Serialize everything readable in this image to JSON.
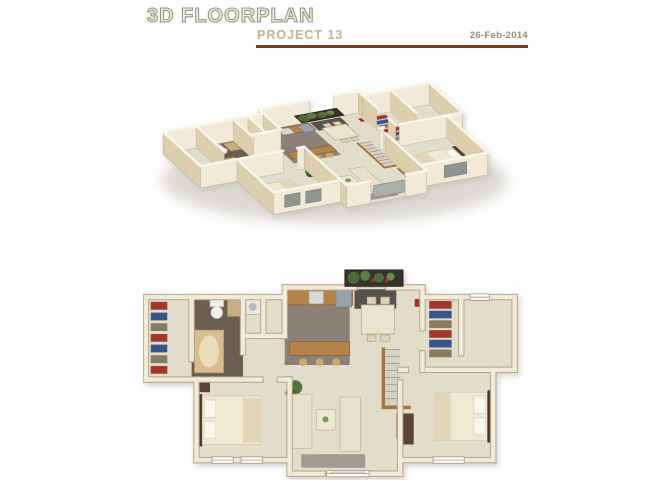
{
  "header": {
    "title": "3D FLOORPLAN",
    "subtitle": "PROJECT 13",
    "date": "26-Feb-2014"
  },
  "palette": {
    "title_olive": "#8f9481",
    "subtitle_tan": "#c7b291",
    "date_brown": "#9b8b77",
    "rule_brick": "#7e3c20",
    "floor": "#e2dccb",
    "wall_fill": "#f1ead8",
    "wall_outline": "#b3a68b",
    "wall_side": "#dbcfae",
    "wall_cap": "#faf6ea",
    "window_dark": "#8f948f",
    "wood": "#b3834a",
    "shadow": "#b9b3a5"
  },
  "views": {
    "isometric": {
      "type": "iso",
      "a": 0.7,
      "b": -0.13,
      "c": 0.44,
      "d": 0.4,
      "tx": 10,
      "ty": 86,
      "wall_h": 22
    },
    "plan": {
      "type": "flat",
      "s": 0.97,
      "tx": 3,
      "ty": 2
    }
  },
  "floorplan": {
    "size": [
      380,
      220
    ],
    "outline": [
      [
        0,
        30
      ],
      [
        143,
        30
      ],
      [
        143,
        20
      ],
      [
        215,
        20
      ],
      [
        250,
        20
      ],
      [
        285,
        20
      ],
      [
        285,
        30
      ],
      [
        380,
        30
      ],
      [
        380,
        105
      ],
      [
        358,
        105
      ],
      [
        358,
        198
      ],
      [
        262,
        198
      ],
      [
        262,
        212
      ],
      [
        148,
        212
      ],
      [
        148,
        198
      ],
      [
        52,
        198
      ],
      [
        52,
        115
      ],
      [
        0,
        115
      ]
    ],
    "walls": [
      [
        0,
        30,
        143,
        30
      ],
      [
        143,
        30,
        143,
        20
      ],
      [
        143,
        20,
        215,
        20
      ],
      [
        250,
        20,
        285,
        20
      ],
      [
        285,
        20,
        285,
        30
      ],
      [
        285,
        30,
        380,
        30
      ],
      [
        380,
        30,
        380,
        105
      ],
      [
        380,
        105,
        358,
        105
      ],
      [
        358,
        105,
        358,
        198
      ],
      [
        358,
        198,
        262,
        198
      ],
      [
        262,
        198,
        262,
        212
      ],
      [
        262,
        212,
        232,
        212
      ],
      [
        182,
        212,
        148,
        212
      ],
      [
        148,
        212,
        148,
        198
      ],
      [
        148,
        198,
        52,
        198
      ],
      [
        52,
        198,
        52,
        115
      ],
      [
        52,
        115,
        0,
        115
      ],
      [
        0,
        115,
        0,
        30
      ],
      [
        47,
        30,
        47,
        94
      ],
      [
        100,
        30,
        100,
        87
      ],
      [
        52,
        115,
        118,
        115
      ],
      [
        138,
        115,
        148,
        115
      ],
      [
        148,
        115,
        148,
        198
      ],
      [
        121,
        30,
        121,
        70
      ],
      [
        104,
        70,
        143,
        70
      ],
      [
        143,
        30,
        143,
        70
      ],
      [
        285,
        30,
        285,
        62
      ],
      [
        285,
        88,
        285,
        105
      ],
      [
        325,
        30,
        325,
        88
      ],
      [
        262,
        105,
        268,
        105
      ],
      [
        290,
        105,
        358,
        105
      ],
      [
        262,
        118,
        262,
        198
      ]
    ],
    "patches": [
      {
        "x": 47,
        "y": 30,
        "w": 53,
        "h": 85,
        "f": "#6a5e50"
      },
      {
        "x": 143,
        "y": 20,
        "w": 67,
        "h": 80,
        "f": "#8b8177"
      },
      {
        "x": 215,
        "y": 22,
        "w": 43,
        "h": 20,
        "f": "#57524b"
      }
    ],
    "furniture": [
      {
        "t": "rect",
        "x": 145,
        "y": 22,
        "w": 68,
        "h": 16,
        "f": "#b3834a",
        "s": "#8a6236"
      },
      {
        "t": "rect",
        "x": 196,
        "y": 23,
        "w": 16,
        "h": 17,
        "f": "#9aa1a8",
        "s": "#7d848b"
      },
      {
        "t": "rect",
        "x": 168,
        "y": 24,
        "w": 15,
        "h": 13,
        "f": "#d9d9d4",
        "s": "#a8a8a2"
      },
      {
        "t": "rect",
        "x": 148,
        "y": 76,
        "w": 62,
        "h": 14,
        "f": "#b3834a",
        "s": "#8a6236"
      },
      {
        "t": "circle",
        "cx": 162,
        "cy": 97,
        "r": 4,
        "f": "#c9a96e"
      },
      {
        "t": "circle",
        "cx": 179,
        "cy": 97,
        "r": 4,
        "f": "#c9a96e"
      },
      {
        "t": "circle",
        "cx": 196,
        "cy": 97,
        "r": 4,
        "f": "#c9a96e"
      },
      {
        "t": "rect",
        "x": 222,
        "y": 38,
        "w": 34,
        "h": 30,
        "f": "#eae3cf",
        "s": "#b8a97f"
      },
      {
        "t": "rect",
        "x": 228,
        "y": 30,
        "w": 9,
        "h": 7,
        "f": "#ddd3b8",
        "s": "#b8a97f"
      },
      {
        "t": "rect",
        "x": 242,
        "y": 30,
        "w": 9,
        "h": 7,
        "f": "#ddd3b8",
        "s": "#b8a97f"
      },
      {
        "t": "rect",
        "x": 228,
        "y": 69,
        "w": 9,
        "h": 7,
        "f": "#ddd3b8",
        "s": "#b8a97f"
      },
      {
        "t": "rect",
        "x": 242,
        "y": 69,
        "w": 9,
        "h": 7,
        "f": "#ddd3b8",
        "s": "#b8a97f"
      },
      {
        "t": "rect",
        "x": 103,
        "y": 32,
        "w": 15,
        "h": 16,
        "f": "#e9e9e4",
        "s": "#a9aaa6"
      },
      {
        "t": "circle",
        "cx": 110,
        "cy": 40,
        "r": 4,
        "f": "#b9bdc1"
      },
      {
        "t": "stripes",
        "x": 5,
        "y": 35,
        "w": 17,
        "n": 7,
        "sh": 8,
        "gap": 3,
        "cols": [
          "#a23730",
          "#36558c",
          "#8a7a60"
        ]
      },
      {
        "t": "stripes",
        "x": 292,
        "y": 34,
        "w": 23,
        "n": 6,
        "sh": 8,
        "gap": 2,
        "cols": [
          "#a23730",
          "#36558c",
          "#8a7a60"
        ]
      },
      {
        "t": "rect",
        "x": 50,
        "y": 64,
        "w": 30,
        "h": 44,
        "f": "#d9bd90",
        "s": "#b49a6e",
        "rx": 9
      },
      {
        "t": "ellipse",
        "cx": 65,
        "cy": 86,
        "rx": 10,
        "ry": 16,
        "f": "#e9dcba"
      },
      {
        "t": "rect",
        "x": 66,
        "y": 32,
        "w": 14,
        "h": 8,
        "f": "#efeee8",
        "s": "#b5b5ae"
      },
      {
        "t": "circle",
        "cx": 73,
        "cy": 46,
        "r": 6,
        "f": "#f2f1ea"
      },
      {
        "t": "rect",
        "x": 84,
        "y": 32,
        "w": 15,
        "h": 18,
        "f": "#c7ad7f",
        "s": "#a08a5f"
      },
      {
        "t": "rect",
        "x": 53,
        "y": 130,
        "w": 5,
        "h": 54,
        "f": "#4f3a29"
      },
      {
        "t": "rect",
        "x": 58,
        "y": 132,
        "w": 60,
        "h": 50,
        "f": "#efe8d3",
        "s": "#cfc3a4"
      },
      {
        "t": "rect",
        "x": 60,
        "y": 136,
        "w": 12,
        "h": 18,
        "f": "#f9f6ec",
        "s": "#d8d0b8"
      },
      {
        "t": "rect",
        "x": 60,
        "y": 158,
        "w": 12,
        "h": 18,
        "f": "#f9f6ec",
        "s": "#d8d0b8"
      },
      {
        "t": "rect",
        "x": 100,
        "y": 134,
        "w": 18,
        "h": 46,
        "f": "#e0d5b6"
      },
      {
        "t": "rect",
        "x": 54,
        "y": 118,
        "w": 12,
        "h": 10,
        "f": "#5a4433"
      },
      {
        "t": "rect",
        "x": 298,
        "y": 128,
        "w": 54,
        "h": 50,
        "f": "#efe8d3",
        "s": "#cfc3a4"
      },
      {
        "t": "rect",
        "x": 352,
        "y": 126,
        "w": 5,
        "h": 54,
        "f": "#4f3a29"
      },
      {
        "t": "rect",
        "x": 338,
        "y": 132,
        "w": 12,
        "h": 18,
        "f": "#f9f6ec",
        "s": "#d8d0b8"
      },
      {
        "t": "rect",
        "x": 338,
        "y": 154,
        "w": 12,
        "h": 18,
        "f": "#f9f6ec",
        "s": "#d8d0b8"
      },
      {
        "t": "rect",
        "x": 298,
        "y": 128,
        "w": 16,
        "h": 50,
        "f": "#e0d5b6"
      },
      {
        "t": "rect",
        "x": 265,
        "y": 150,
        "w": 11,
        "h": 32,
        "f": "#5a4433"
      },
      {
        "t": "circle",
        "cx": 154,
        "cy": 123,
        "r": 7,
        "f": "#53743f"
      },
      {
        "t": "circle",
        "cx": 149,
        "cy": 129,
        "r": 5,
        "f": "#3f5c30"
      },
      {
        "t": "rect",
        "x": 150,
        "y": 130,
        "w": 21,
        "h": 56,
        "f": "#e7e0cb",
        "s": "#c2b899"
      },
      {
        "t": "rect",
        "x": 200,
        "y": 133,
        "w": 21,
        "h": 56,
        "f": "#e7e0cb",
        "s": "#c2b899"
      },
      {
        "t": "rect",
        "x": 176,
        "y": 146,
        "w": 19,
        "h": 21,
        "f": "#ece6d2",
        "s": "#c2b899"
      },
      {
        "t": "circle",
        "cx": 185,
        "cy": 156,
        "r": 3,
        "f": "#7c9a52"
      },
      {
        "t": "rect",
        "x": 160,
        "y": 192,
        "w": 66,
        "h": 14,
        "f": "#a09c93"
      },
      {
        "t": "rect",
        "x": 258,
        "y": 150,
        "w": 3.5,
        "h": 26,
        "f": "#a5763f"
      },
      {
        "t": "rect",
        "x": 277,
        "y": 32,
        "w": 5,
        "h": 8,
        "f": "#a33327"
      },
      {
        "t": "rect",
        "x": 243,
        "y": 82,
        "w": 3.5,
        "h": 62,
        "f": "#a5763f"
      },
      {
        "t": "stairs",
        "x": 247,
        "y": 84,
        "w": 15,
        "h": 58,
        "n": 8,
        "f": "#d8d2c4",
        "ln": "#9e988c"
      },
      {
        "t": "rect",
        "x": 243,
        "y": 142,
        "w": 30,
        "h": 3.5,
        "f": "#a5763f"
      }
    ],
    "above": [
      {
        "t": "rect",
        "x": 205,
        "y": 2,
        "w": 60,
        "h": 17,
        "f": "#37322b",
        "s": "#1f1c17"
      },
      {
        "t": "circle",
        "cx": 214,
        "cy": 10,
        "r": 6,
        "f": "#4e6b3a"
      },
      {
        "t": "circle",
        "cx": 226,
        "cy": 8,
        "r": 5,
        "f": "#5d7c44"
      },
      {
        "t": "circle",
        "cx": 240,
        "cy": 10,
        "r": 5,
        "f": "#4e6b3a"
      },
      {
        "t": "circle",
        "cx": 252,
        "cy": 9,
        "r": 4,
        "f": "#6b8a50"
      },
      {
        "t": "circle",
        "cx": 234,
        "cy": 13,
        "r": 2,
        "f": "#a03028"
      },
      {
        "t": "circle",
        "cx": 248,
        "cy": 13,
        "r": 2,
        "f": "#a03028"
      }
    ],
    "windows": [
      {
        "x1": 68,
        "y": 198,
        "x2": 90
      },
      {
        "x1": 98,
        "y": 198,
        "x2": 120
      },
      {
        "x1": 186,
        "y": 212,
        "x2": 230,
        "slider": true
      },
      {
        "x1": 296,
        "y": 198,
        "x2": 328
      },
      {
        "x1": 334,
        "y": 30,
        "x2": 354,
        "skipIso": true
      }
    ]
  }
}
